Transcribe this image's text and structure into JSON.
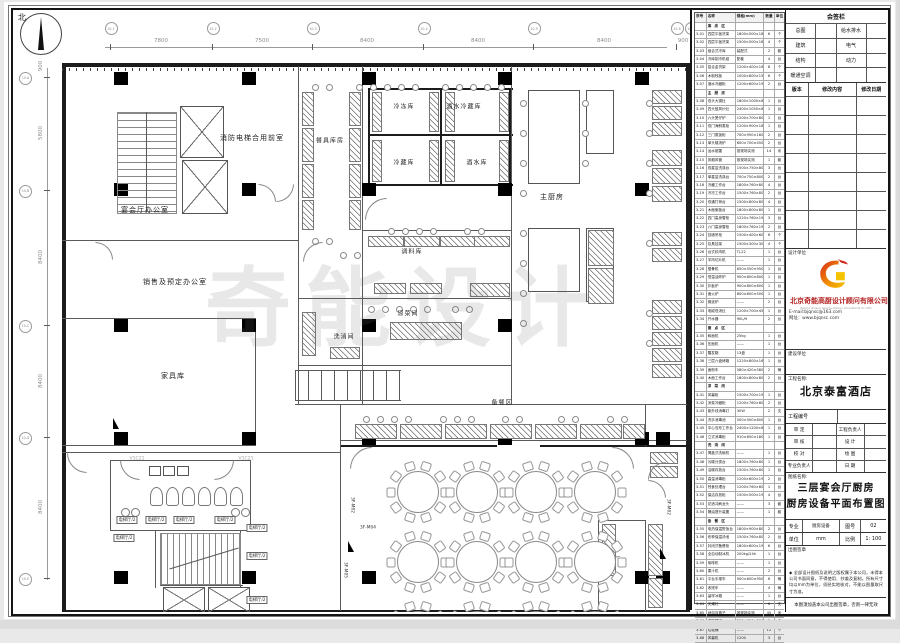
{
  "watermark": "奇能设计",
  "north_label": "北",
  "plan": {
    "dims_top": {
      "bubbles": [
        "10-1",
        "10-2",
        "10-3",
        "10-4",
        "10-5",
        "10-6",
        "10-7"
      ],
      "labels": [
        "7800",
        "7500",
        "8400",
        "8400",
        "8400",
        "900"
      ]
    },
    "dims_left": {
      "bubbles": [
        "10-A",
        "10-B",
        "10-C",
        "10-D",
        "10-E"
      ],
      "labels": [
        "900",
        "5800",
        "8400",
        "8400",
        "8400"
      ]
    },
    "labels": [
      {
        "t": "消防电梯合用前室",
        "x": 252,
        "y": 138,
        "c": "room",
        "n": "room-label-fire-elevator-lobby"
      },
      {
        "t": "宴会厅办公室",
        "x": 145,
        "y": 210,
        "c": "room",
        "n": "room-label-banquet-office"
      },
      {
        "t": "销售及预定办公室",
        "x": 175,
        "y": 282,
        "c": "room",
        "n": "room-label-sales-office"
      },
      {
        "t": "家具库",
        "x": 173,
        "y": 376,
        "c": "room",
        "n": "room-label-furniture-store"
      },
      {
        "t": "餐具库房",
        "x": 330,
        "y": 140,
        "c": "room s6",
        "n": "room-label-tableware-store"
      },
      {
        "t": "冷冻库",
        "x": 404,
        "y": 106,
        "c": "room s6",
        "n": "room-label-freezer"
      },
      {
        "t": "酒水冷藏库",
        "x": 464,
        "y": 106,
        "c": "room s6",
        "n": "room-label-beverage-cold-store"
      },
      {
        "t": "冷藏库",
        "x": 404,
        "y": 162,
        "c": "room s6",
        "n": "room-label-cold-store"
      },
      {
        "t": "酒水库",
        "x": 477,
        "y": 162,
        "c": "room s6",
        "n": "room-label-beverage-store"
      },
      {
        "t": "主厨房",
        "x": 552,
        "y": 197,
        "c": "room",
        "n": "room-label-main-kitchen"
      },
      {
        "t": "调料库",
        "x": 412,
        "y": 251,
        "c": "room s6",
        "n": "room-label-seasoning-store"
      },
      {
        "t": "凉菜间",
        "x": 408,
        "y": 313,
        "c": "room s6",
        "n": "room-label-cold-dish-room"
      },
      {
        "t": "洗消间",
        "x": 344,
        "y": 336,
        "c": "room s6",
        "n": "room-label-washing-room"
      },
      {
        "t": "备餐区",
        "x": 502,
        "y": 402,
        "c": "room s6",
        "n": "room-label-pantry-area"
      },
      {
        "t": "电梯厅/2",
        "x": 127,
        "y": 520,
        "c": "boxed",
        "n": "label-elevator-hall"
      },
      {
        "t": "电梯厅/2",
        "x": 156,
        "y": 520,
        "c": "boxed",
        "n": "label-elevator-hall"
      },
      {
        "t": "电梯厅/2",
        "x": 184,
        "y": 520,
        "c": "boxed",
        "n": "label-elevator-hall"
      },
      {
        "t": "电梯厅/2",
        "x": 225,
        "y": 520,
        "c": "boxed",
        "n": "label-elevator-hall"
      },
      {
        "t": "电梯厅/2",
        "x": 124,
        "y": 538,
        "c": "boxed",
        "n": "label-elevator-hall"
      },
      {
        "t": "电梯厅/2",
        "x": 257,
        "y": 528,
        "c": "boxed",
        "n": "label-elevator-hall"
      },
      {
        "t": "电梯厅/2",
        "x": 257,
        "y": 556,
        "c": "boxed",
        "n": "label-elevator-hall"
      },
      {
        "t": "电梯厅/2",
        "x": 257,
        "y": 600,
        "c": "boxed",
        "n": "label-elevator-hall"
      },
      {
        "t": "V1C21",
        "x": 137,
        "y": 459,
        "c": "gray",
        "n": "label-v1c21"
      },
      {
        "t": "V1C21",
        "x": 246,
        "y": 459,
        "c": "gray",
        "n": "label-v1c21"
      },
      {
        "t": "3F-M04",
        "x": 368,
        "y": 528,
        "c": "tag",
        "n": "door-label"
      },
      {
        "t": "3F-M02",
        "x": 352,
        "y": 505,
        "c": "tag vert",
        "n": "door-label"
      },
      {
        "t": "3F-M05",
        "x": 345,
        "y": 570,
        "c": "tag vert",
        "n": "door-label"
      },
      {
        "t": "3F-M02",
        "x": 668,
        "y": 507,
        "c": "tag vert",
        "n": "door-label"
      }
    ]
  },
  "equipment_table": {
    "headers": [
      "序号",
      "名称",
      "规格(mm)",
      "数量",
      "单位"
    ],
    "rows": [
      [
        "",
        "库 房 区",
        "",
        "",
        ""
      ],
      [
        "3-01",
        "四层平板货架",
        "1800×500×1800",
        "6",
        "个"
      ],
      [
        "3-02",
        "四层平板货架",
        "1500×500×1800",
        "4",
        "个"
      ],
      [
        "3-03",
        "组合式冷库",
        "装配式",
        "2",
        "套"
      ],
      [
        "3-04",
        "冷库制冷机组",
        "配套",
        "4",
        "台"
      ],
      [
        "3-05",
        "铝合金货架",
        "1200×400×1600",
        "8",
        "个"
      ],
      [
        "3-06",
        "木制栈板",
        "1000×800×150",
        "6",
        "个"
      ],
      [
        "3-07",
        "酒水冷藏柜",
        "1200×600×1950",
        "2",
        "台"
      ],
      [
        "",
        "主 厨 房",
        "",
        "",
        ""
      ],
      [
        "3-08",
        "双头大锅灶",
        "1800×1000×800+450",
        "1",
        "台"
      ],
      [
        "3-09",
        "四头鼓风炒灶",
        "2400×1050×800+450",
        "1",
        "台"
      ],
      [
        "3-10",
        "六头煲仔炉",
        "1200×700×800",
        "1",
        "台"
      ],
      [
        "3-11",
        "双门海鲜蒸柜",
        "1200×900×1850",
        "1",
        "台"
      ],
      [
        "3-12",
        "三门蒸饭柜",
        "700×950×1600",
        "2",
        "台"
      ],
      [
        "3-13",
        "单头矮汤炉",
        "600×700×450",
        "2",
        "台"
      ],
      [
        "3-14",
        "运水烟罩",
        "按现场实测",
        "14",
        "米"
      ],
      [
        "3-15",
        "排烟风管",
        "按现场实测",
        "1",
        "套"
      ],
      [
        "3-16",
        "双星盆洗涤台",
        "1500×750×800",
        "3",
        "台"
      ],
      [
        "3-17",
        "单星盆洗涤台",
        "700×750×800",
        "2",
        "台"
      ],
      [
        "3-18",
        "冷藏工作台",
        "1800×760×800",
        "4",
        "台"
      ],
      [
        "3-19",
        "冷冻工作台",
        "1500×760×800",
        "2",
        "台"
      ],
      [
        "3-20",
        "双通打荷台",
        "1500×800×800",
        "4",
        "台"
      ],
      [
        "3-21",
        "木面案板台",
        "1800×800×800",
        "1",
        "台"
      ],
      [
        "3-22",
        "四门高身雪柜",
        "1220×760×1950",
        "3",
        "台"
      ],
      [
        "3-23",
        "六门高身雪柜",
        "1800×760×1950",
        "2",
        "台"
      ],
      [
        "3-24",
        "挂墙吊柜",
        "1500×400×600",
        "6",
        "个"
      ],
      [
        "3-25",
        "炊具挂架",
        "1500×300×300",
        "4",
        "个"
      ],
      [
        "3-26",
        "台式绞肉机",
        "TJ-22",
        "1",
        "台"
      ],
      [
        "3-27",
        "羊肉切片机",
        "——",
        "1",
        "台"
      ],
      [
        "3-28",
        "锯骨机",
        "650×550×950",
        "1",
        "台"
      ],
      [
        "3-29",
        "恒温油炸炉",
        "900×800×800",
        "1",
        "台"
      ],
      [
        "3-30",
        "扒板炉",
        "900×800×800",
        "1",
        "台"
      ],
      [
        "3-31",
        "面火炉",
        "800×600×500",
        "1",
        "台"
      ],
      [
        "3-32",
        "微波炉",
        "——",
        "2",
        "台"
      ],
      [
        "3-33",
        "电磁低汤灶",
        "1200×700×450",
        "1",
        "台"
      ],
      [
        "3-34",
        "开水器",
        "90L/H",
        "2",
        "台"
      ],
      [
        "",
        "面 点 区",
        "",
        "",
        ""
      ],
      [
        "3-35",
        "和面机",
        "25kg",
        "1",
        "台"
      ],
      [
        "3-36",
        "压面机",
        "——",
        "1",
        "台"
      ],
      [
        "3-37",
        "醒发箱",
        "13盘",
        "1",
        "台"
      ],
      [
        "3-38",
        "三层六盘烤箱",
        "1220×800×1600",
        "1",
        "台"
      ],
      [
        "3-39",
        "面粉车",
        "580×420×580",
        "2",
        "辆"
      ],
      [
        "3-40",
        "木面工作台",
        "1800×800×800",
        "2",
        "台"
      ],
      [
        "",
        "凉 菜 间",
        "",
        "",
        ""
      ],
      [
        "3-41",
        "风幕柜",
        "1500×700×1950",
        "1",
        "台"
      ],
      [
        "3-42",
        "凉菜冷藏柜",
        "1200×760×800",
        "2",
        "台"
      ],
      [
        "3-43",
        "紫外线消毒灯",
        "30W",
        "2",
        "支"
      ],
      [
        "3-44",
        "洗手消毒池",
        "500×500×800",
        "1",
        "台"
      ],
      [
        "3-45",
        "中心岛形工作台",
        "2400×1200×800",
        "1",
        "台"
      ],
      [
        "3-46",
        "立式消毒柜",
        "910×650×1800",
        "1",
        "台"
      ],
      [
        "",
        "洗 消 间",
        "",
        "",
        ""
      ],
      [
        "3-47",
        "揭盖式洗碗机",
        "——",
        "1",
        "台"
      ],
      [
        "3-48",
        "污碟分类台",
        "1800×760×800",
        "1",
        "台"
      ],
      [
        "3-49",
        "洁碟存放台",
        "1500×760×800",
        "1",
        "台"
      ],
      [
        "3-50",
        "高温消毒柜",
        "1200×600×1950",
        "2",
        "台"
      ],
      [
        "3-51",
        "残食处理台",
        "1200×760×800",
        "1",
        "台"
      ],
      [
        "3-52",
        "保洁存放柜",
        "1500×500×1950",
        "4",
        "台"
      ],
      [
        "3-53",
        "花洒冲刷龙头",
        "——",
        "3",
        "套"
      ],
      [
        "3-54",
        "隔油提升装置",
        "——",
        "1",
        "套"
      ],
      [
        "",
        "备 餐 区",
        "",
        "",
        ""
      ],
      [
        "3-55",
        "电热保温售饭台",
        "1800×900×800",
        "2",
        "台"
      ],
      [
        "3-56",
        "布菲保温汤池",
        "1500×760×800",
        "2",
        "台"
      ],
      [
        "3-57",
        "封闭式备餐柜",
        "1800×600×1950",
        "6",
        "台"
      ],
      [
        "3-58",
        "全自动制冰机",
        "200kg/24h",
        "1",
        "台"
      ],
      [
        "3-59",
        "咖啡机",
        "——",
        "1",
        "台"
      ],
      [
        "3-60",
        "果汁机",
        "——",
        "2",
        "台"
      ],
      [
        "3-61",
        "平台手推车",
        "900×600×950",
        "6",
        "辆"
      ],
      [
        "3-62",
        "收残车",
        "——",
        "4",
        "辆"
      ],
      [
        "3-63",
        "留样冰箱",
        "——",
        "1",
        "台"
      ],
      [
        "3-64",
        "灭蝇灯",
        "——",
        "6",
        "支"
      ],
      [
        "3-65",
        "地沟及篦子",
        "按现场实测",
        "45",
        "米"
      ],
      [
        "3-66",
        "洗拖把池",
        "600×600×500",
        "2",
        "个"
      ],
      [
        "3-67",
        "垃圾桶",
        "——",
        "12",
        "个"
      ],
      [
        "3-68",
        "风幕机",
        "1200",
        "3",
        "台"
      ]
    ]
  },
  "title_block": {
    "sign_title": "会签栏",
    "sign_rows": [
      [
        "总图",
        "",
        "给水排水",
        ""
      ],
      [
        "建筑",
        "",
        "电气",
        ""
      ],
      [
        "结构",
        "",
        "动力",
        ""
      ],
      [
        "暖通空调",
        "",
        "",
        ""
      ]
    ],
    "version_headers": [
      "版本",
      "修改内容",
      "修改日期"
    ],
    "version_rows": [
      [
        "",
        "",
        ""
      ],
      [
        "",
        "",
        ""
      ],
      [
        "",
        "",
        ""
      ],
      [
        "",
        "",
        ""
      ],
      [
        "",
        "",
        ""
      ],
      [
        "",
        "",
        ""
      ],
      [
        "",
        "",
        ""
      ],
      [
        "",
        "",
        ""
      ]
    ],
    "design_unit_label": "设计单位",
    "company_cn": "北京奇能高厨设计顾问有限公司",
    "company_en": "Beijing Qineng Gaochu Design Consultants Co.,LTD",
    "email": "E-mail:bjqnsc@163.com",
    "website": "网址：www.bjqnsc.com",
    "build_unit_label": "建设单位",
    "project_name_label": "工程名称:",
    "project_name": "北京泰富酒店",
    "project_no_label": "工程编号",
    "approval_rows": [
      [
        "审 定",
        "",
        "工程负责人",
        ""
      ],
      [
        "审 核",
        "",
        "设 计",
        ""
      ],
      [
        "校 对",
        "",
        "绘 图",
        ""
      ],
      [
        "专业负责人",
        "",
        "日 期",
        ""
      ]
    ],
    "drawing_name_label": "图纸名称:",
    "drawing_name_line1": "三层宴会厅厨房",
    "drawing_name_line2": "厨房设备平面布置图",
    "spec_row": [
      "专业",
      "厨房设备",
      "图号",
      "02"
    ],
    "unit_row": [
      "单位",
      "mm",
      "比例",
      "1: 100"
    ],
    "stamp_label": "出图签章",
    "note1": "◆ 全部设计图纸及说明之版权属于本公司，未得本公司书面同意，不得使用、抄袭及复制。所有尺寸均以mm为单位，须经实地核对，不能以图量取尺寸为准。",
    "note2": "本图须加盖本公司出图签章，否则一律无效"
  },
  "colors": {
    "logo_red": "#d5281e",
    "logo_orange": "#f08c00",
    "logo_yellow": "#f5c400",
    "company_red": "#b42222"
  }
}
